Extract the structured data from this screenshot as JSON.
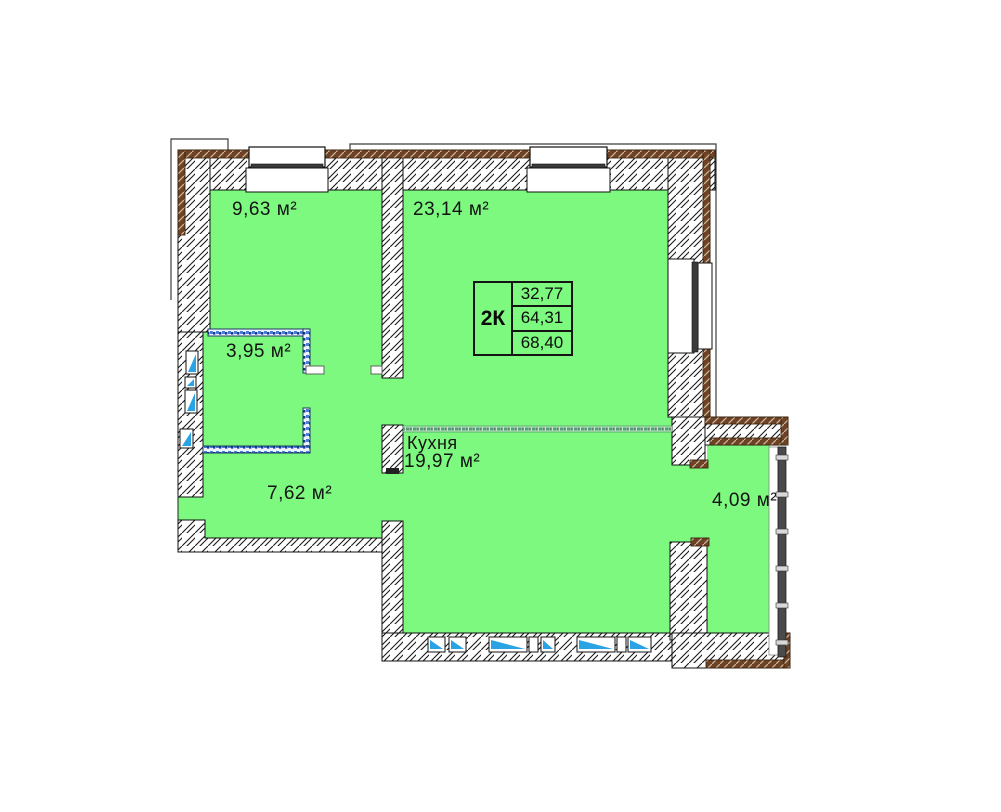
{
  "apartment": {
    "type_label": "2К",
    "areas": [
      "32,77",
      "64,31",
      "68,40"
    ]
  },
  "rooms": [
    {
      "id": "room-top-left",
      "label": "9,63 м²"
    },
    {
      "id": "room-top-right",
      "label": "23,14 м²"
    },
    {
      "id": "bathroom",
      "label": "3,95 м²"
    },
    {
      "id": "hallway",
      "label": "7,62 м²"
    },
    {
      "id": "kitchen",
      "name": "Кухня",
      "label": "19,97 м²"
    },
    {
      "id": "balcony",
      "label": "4,09 м²"
    }
  ],
  "colors": {
    "room_fill": "#7CF97E",
    "wall_edge_brown": "#6E4223",
    "vent_blue": "#29A3E4",
    "partition_blue": "#4A7FD8",
    "separator_teal": "#4F9E7F"
  }
}
